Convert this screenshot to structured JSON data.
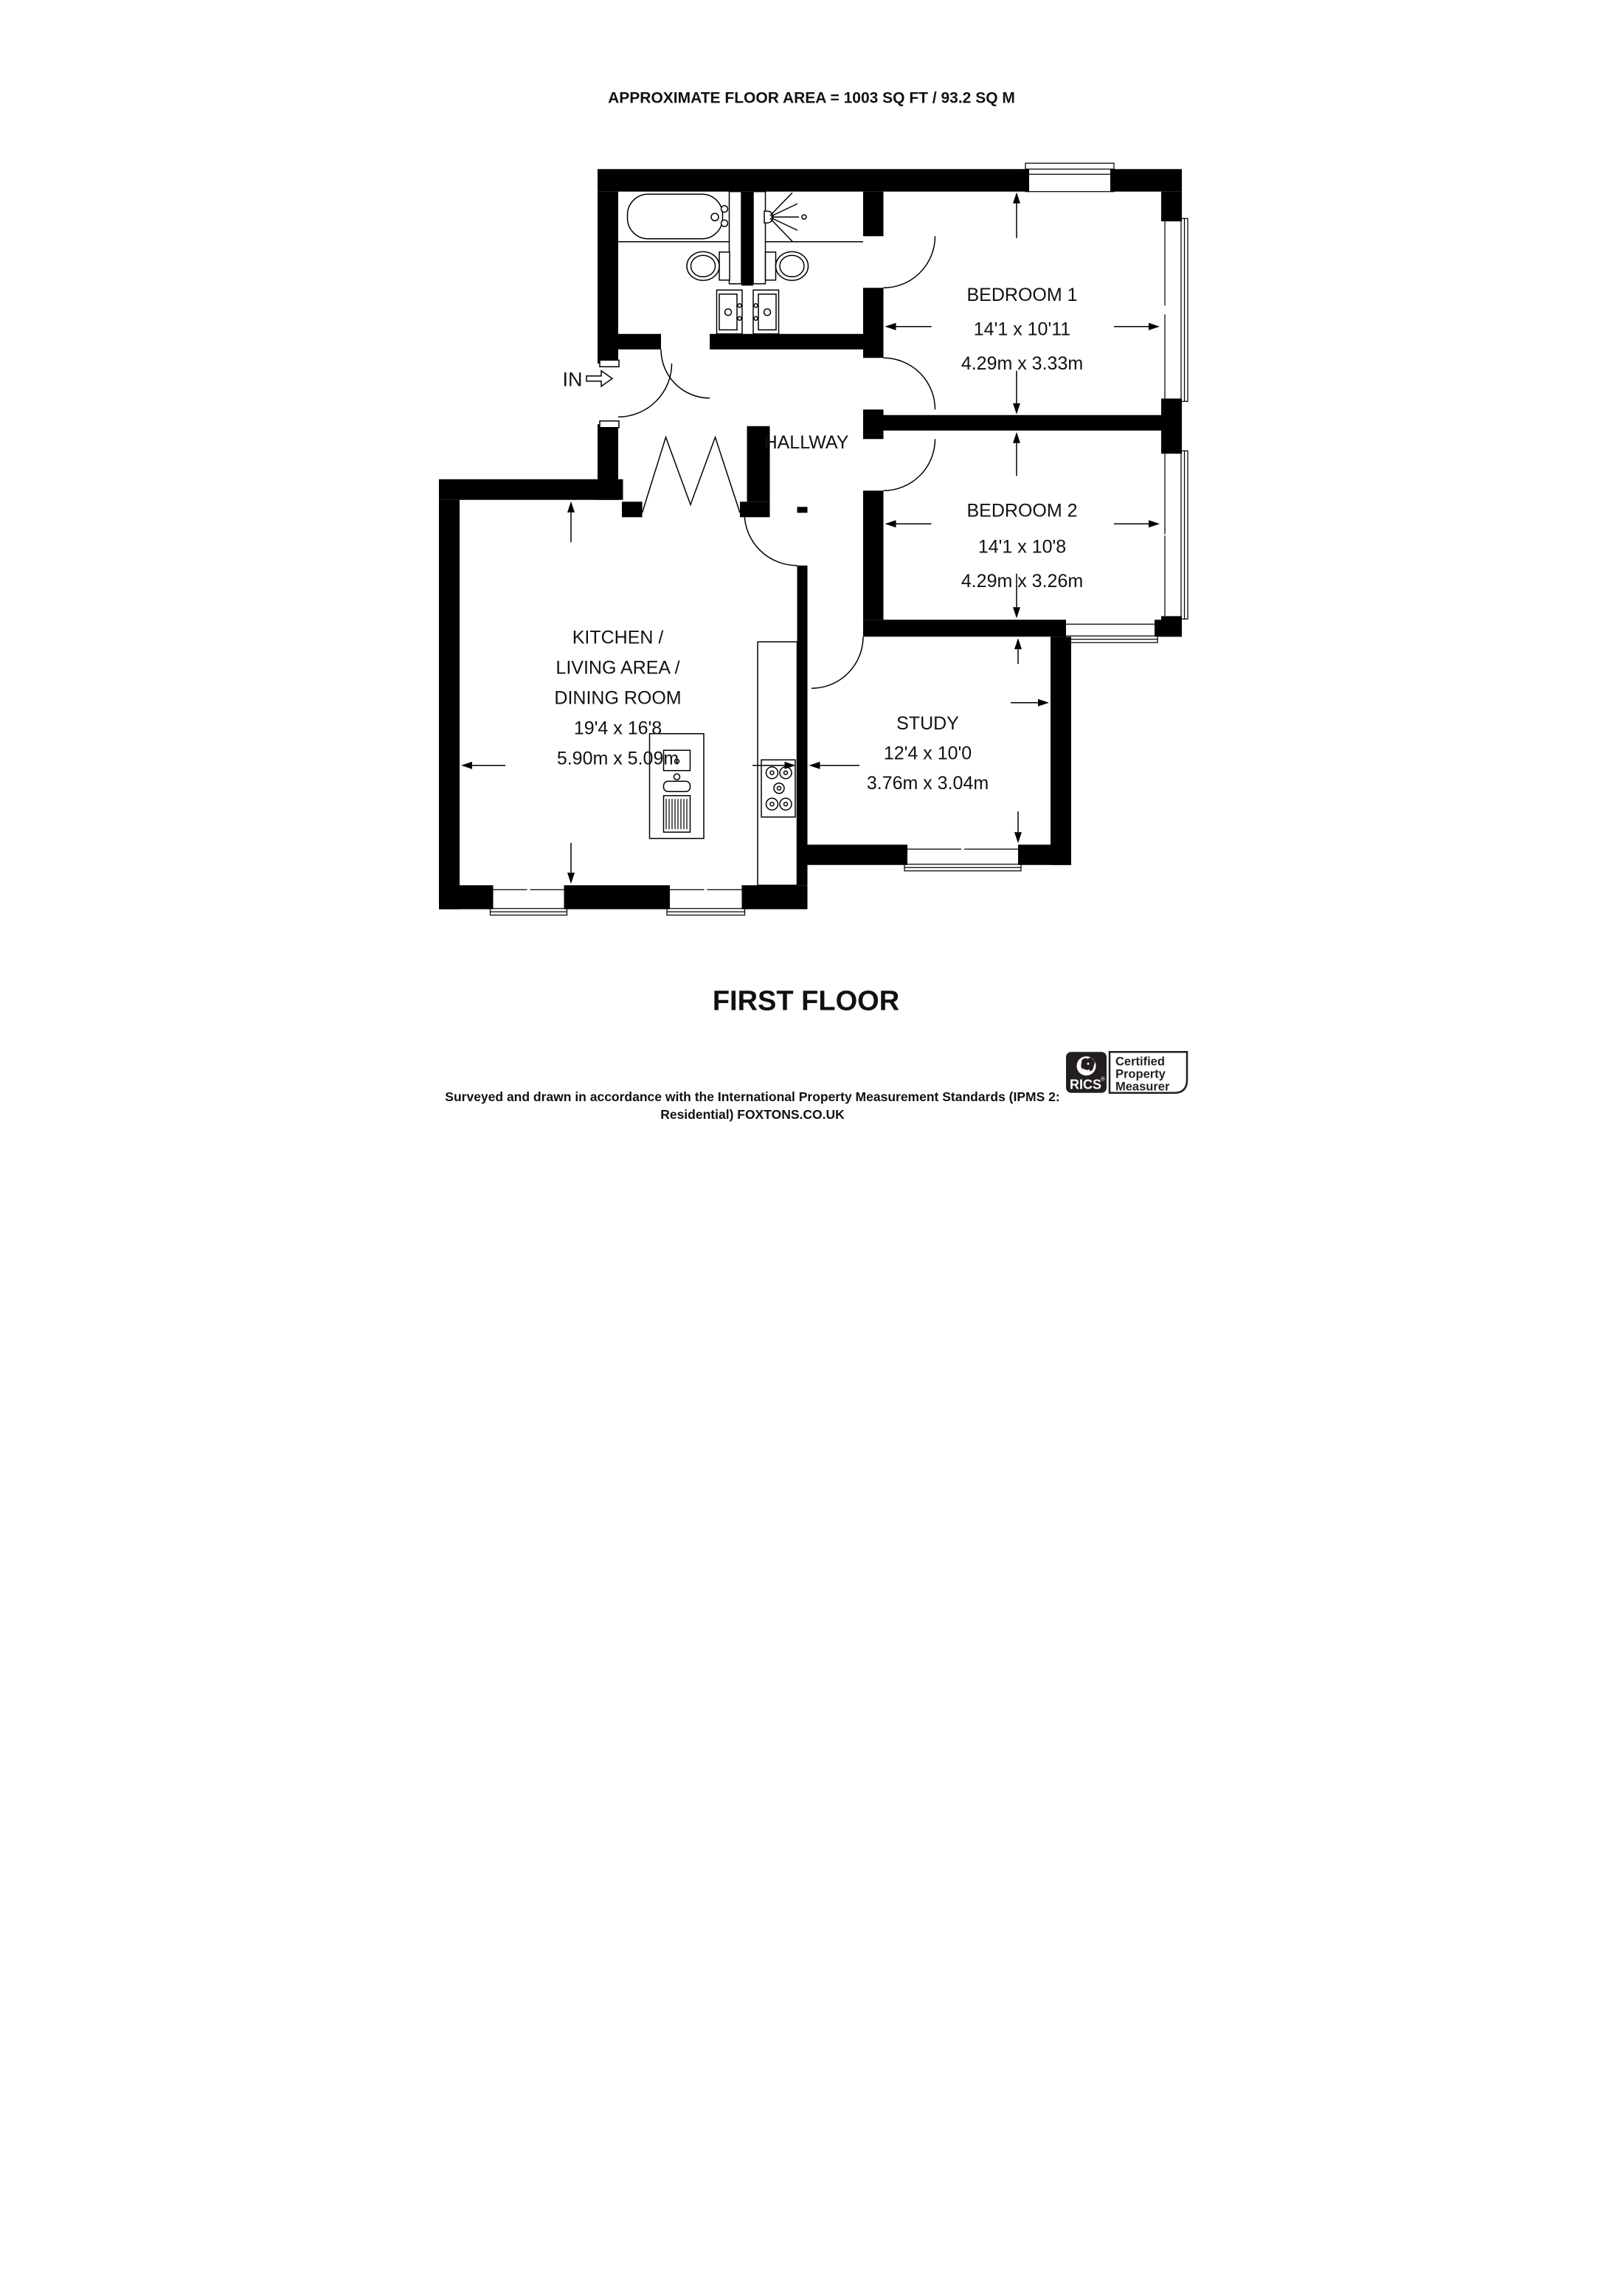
{
  "title": "APPROXIMATE FLOOR AREA = 1003 SQ FT / 93.2 SQ M",
  "floor_label": "FIRST FLOOR",
  "entrance": {
    "label": "IN"
  },
  "rooms": {
    "hallway": {
      "name": "HALLWAY"
    },
    "bedroom1": {
      "name": "BEDROOM 1",
      "dimensions_imperial": "14'1 x 10'11",
      "dimensions_metric": "4.29m x 3.33m"
    },
    "bedroom2": {
      "name": "BEDROOM 2",
      "dimensions_imperial": "14'1 x 10'8",
      "dimensions_metric": "4.29m x 3.26m"
    },
    "study": {
      "name": "STUDY",
      "dimensions_imperial": "12'4 x 10'0",
      "dimensions_metric": "3.76m x 3.04m"
    },
    "kitchen": {
      "name_line1": "KITCHEN /",
      "name_line2": "LIVING AREA /",
      "name_line3": "DINING ROOM",
      "dimensions_imperial": "19'4 x 16'8",
      "dimensions_metric": "5.90m x 5.09m"
    }
  },
  "footer": {
    "line1": "Surveyed and drawn in accordance with the International Property Measurement Standards (IPMS 2:",
    "line2": "Residential) FOXTONS.CO.UK"
  },
  "logo": {
    "brand": "RICS",
    "registered_mark": "®",
    "cert_line1": "Certified",
    "cert_line2": "Property",
    "cert_line3": "Measurer"
  },
  "icons": {
    "bathtub-icon": "plan bathtub symbol",
    "shower-icon": "shower head with spray",
    "toilet-icon": "toilet with cistern",
    "sink-icon": "vanity basin unit",
    "kitchen-island-icon": "sink and drainer unit",
    "hob-icon": "five ring hob",
    "closet-doors-icon": "bifold closet doors",
    "entry-arrow-icon": "entrance direction arrow",
    "lion-icon": "RICS lion head mark"
  },
  "colors": {
    "wall": "#000000",
    "background": "#ffffff",
    "logo_dark": "#231f20"
  }
}
